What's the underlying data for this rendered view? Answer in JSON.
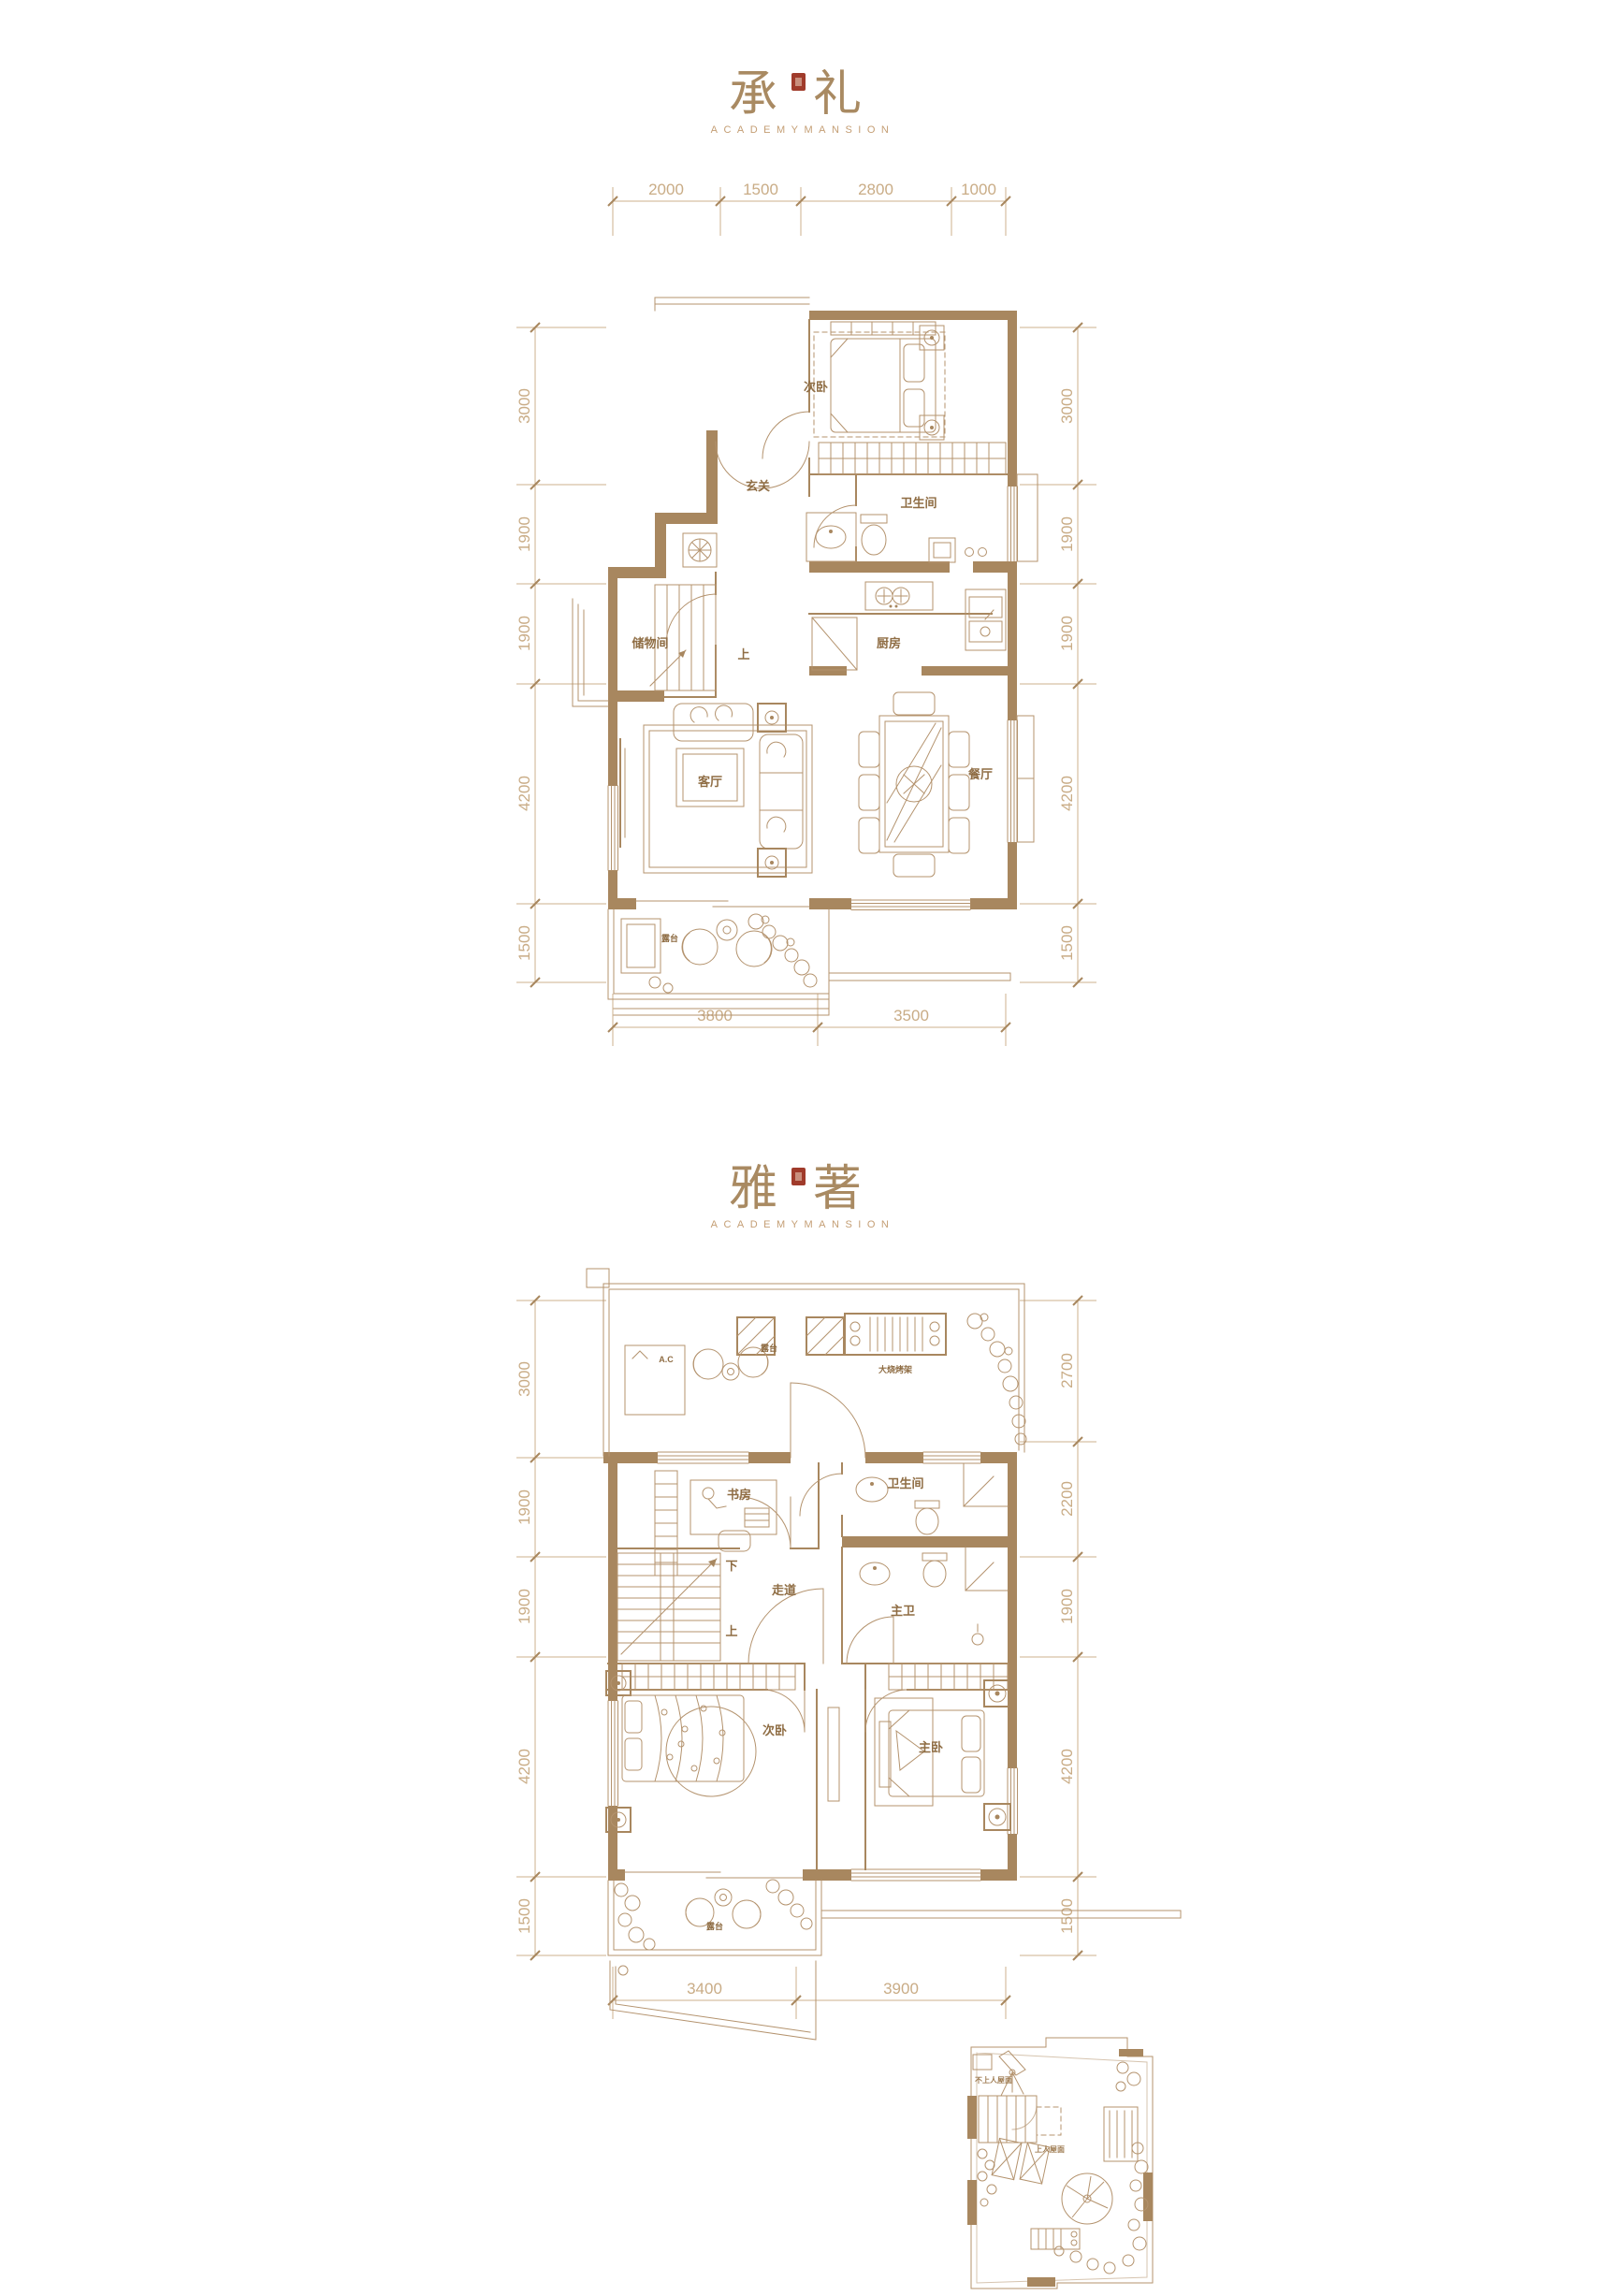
{
  "colors": {
    "line": "#b4936e",
    "wall_fill": "#a8875f",
    "dim_line": "#cdb08c",
    "dim_text": "#c9ac86",
    "room_text": "#8f6d44",
    "title_text": "#a98a62",
    "subtitle_text": "#c49e74",
    "seal_red": "#a03b2b"
  },
  "plan1": {
    "title": {
      "char_left": "承",
      "char_right": "礼",
      "subtitle": "ACADEMYMANSION"
    },
    "dims": {
      "top": [
        "2000",
        "1500",
        "2800",
        "1000"
      ],
      "left": [
        "3000",
        "1900",
        "1900",
        "4200",
        "1500"
      ],
      "right": [
        "3000",
        "1900",
        "1900",
        "4200",
        "1500"
      ],
      "bottom": [
        "3800",
        "3500"
      ]
    },
    "rooms": {
      "bedroom2": "次卧",
      "entry": "玄关",
      "bathroom": "卫生间",
      "kitchen": "厨房",
      "storage": "储物间",
      "stairs_up": "上",
      "living": "客厅",
      "dining": "餐厅",
      "terrace": "露台"
    }
  },
  "plan2": {
    "title": {
      "char_left": "雅",
      "char_right": "著",
      "subtitle": "ACADEMYMANSION"
    },
    "dims": {
      "left": [
        "3000",
        "1900",
        "1900",
        "4200",
        "1500"
      ],
      "right": [
        "2700",
        "2200",
        "1900",
        "4200",
        "1500"
      ],
      "bottom": [
        "3400",
        "3900"
      ]
    },
    "rooms": {
      "terrace_top": "露台",
      "ac_unit": "A.C",
      "bbq": "大烧烤架",
      "study": "书房",
      "bathroom": "卫生间",
      "corridor": "走道",
      "stairs_down": "下",
      "stairs_up": "上",
      "master_bath": "主卫",
      "bedroom2": "次卧",
      "master_bedroom": "主卧",
      "terrace_bottom": "露台"
    }
  },
  "roof_inset": {
    "labels": {
      "non_accessible_roof": "不上人屋面",
      "accessible_roof": "上人屋面"
    }
  }
}
